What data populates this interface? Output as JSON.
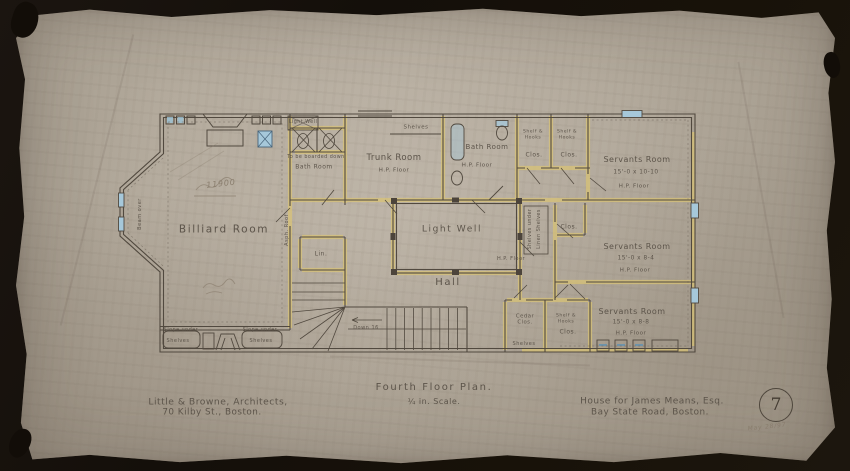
{
  "title_block": {
    "architect_line1": "Little & Browne, Architects,",
    "architect_line2": "70 Kilby St., Boston.",
    "drawing_title": "Fourth Floor Plan.",
    "drawing_scale": "¼ in. Scale.",
    "client_line1": "House for James Means, Esq.",
    "client_line2": "Bay State Road, Boston.",
    "sheet_number": "7",
    "date_note": "May 28/97"
  },
  "plan": {
    "labels": {
      "billiard_room": "Billiard Room",
      "trunk_room": "Trunk Room",
      "hp_floor": "H.P. Floor",
      "shelves": "Shelves",
      "light_well": "Light Well",
      "hall": "Hall",
      "bath_room": "Bath Room",
      "bath_note": "To be boarded down",
      "servants_room": "Servants Room",
      "s1_dim": "15'-0 x 10-10",
      "s2_dim": "15'-0 x 8-4",
      "s3_dim": "15'-0 x 8-8",
      "clos": "Clos.",
      "shelf_hooks": "Shelf & Hooks",
      "cedar_clos": "Cedar Clos.",
      "lin": "Lin.",
      "linen_shelves": "Linen Shelves",
      "shelves_under": "Shelves under",
      "down_16": "Down 16",
      "slope_under": "Slope under",
      "beam_over": "Beam over",
      "asph_roof": "Asph. Roof",
      "pencil_note": "11900"
    }
  }
}
